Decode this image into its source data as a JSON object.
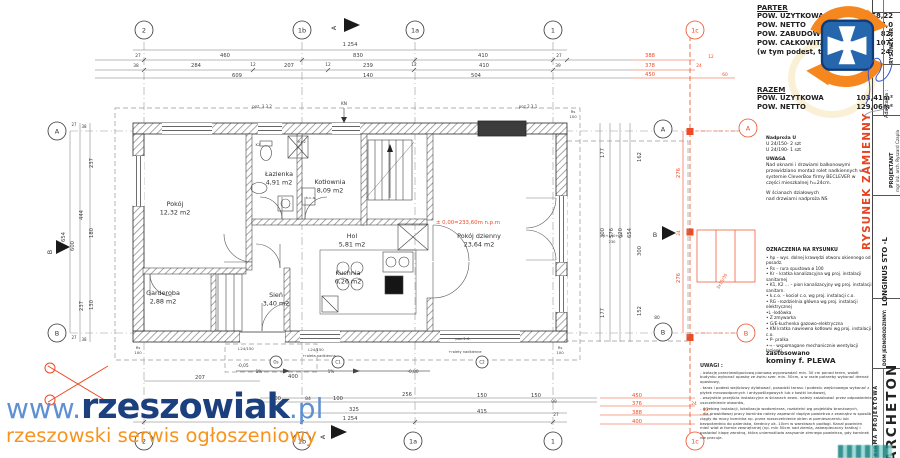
{
  "stats": {
    "parter_title": "PARTER",
    "parter_rows": [
      {
        "label": "POW. UZYTKOWA",
        "value": "58,22"
      },
      {
        "label": "POW. NETTO",
        "value": "67,0"
      },
      {
        "label": "POW. ZABUDOWY",
        "value": "82,"
      },
      {
        "label": "POW. CAŁKOWITA",
        "value": "107,"
      },
      {
        "label": "(w tym podest, taras",
        "value": "24,"
      }
    ],
    "razem_title": "RAZEM",
    "razem_rows": [
      {
        "label": "POW. UZYTKOWA",
        "value": "103,41m²"
      },
      {
        "label": "POW. NETTO",
        "value": "129,06m²"
      }
    ]
  },
  "notes": {
    "nadproza_title": "Nadproża U",
    "nadproza_l1": "U 24/150- 2 szt",
    "nadproza_l2": "U 24/190- 1 szt",
    "uwaga_title": "UWAGA",
    "uwaga_text": "Nad oknami i drzwiami balkonowymi przewidziano montaż rolet nadkiennych w systemie CleverBox firmy BECLEVER  w części mieszkalnej  h=24cm.",
    "sciany_text1": "W ścianach działowych",
    "sciany_text2": "nad drzwiami nadproża NS",
    "oznaczenia_title": "OZNACZENIA NA RYSUNKU",
    "oznaczenia_items": [
      "• hp – wys. dolnej krawędzi otworu  okiennego od posadz.",
      "• Rs – rura spustowa ø 100",
      "• Kr – kratka kanalizacyjna wg proj. instalacji sanitarnej",
      "• K1, K2 ... – pion kanalizacyjny wg proj. instalacji sanitarn.",
      "• k.c.o. – kocioł c.o.  wg proj. instalacji c.o.",
      "• RG –rozdzielnia główna wg proj. instalacji elektrycznej",
      "•L -lodówka",
      "• Z zmywarka",
      "• G/E-kuchenka gazowo-elektryczna",
      "• KN kratka nawiewna kotłowni wg proj. instalacji c.o.",
      "• P- pralka",
      "•⇢  - wspomagane mechanicznie wentylacji łazienki"
    ],
    "kominy_l1": "zastosowano",
    "kominy_l2": "kominy f. PLEWA",
    "uwagi_title": "UWAGI :",
    "uwagi_items": [
      "- izolację przeciwwilgociową pionową wyprowadzić min. 30 cm ponad teren, wokół budynku wykonać opaskę ze żwiru szer. min. 50cm, a w razie potrzeby wykonać drenaż opaskowy,",
      "- taras i podest wejściowy dylatować, posadzki tarasu i podestu wejściowego wykonać  z płytek mrozoodpornych i antypoślizgowych lub z kostki brukowej,",
      "- wszystkie przejścia instalacyjne w ścianach zewn. należy zaizolować przez odpowiednie uszczelnienie otworów,",
      "- przebieg instalacji, lokalizacja wodomierza, rozdzielni  wg projektów branżowych,",
      "- dla prawidłowej pracy kominka należy zapewnić dopływ powietrza z zewnątrz w sposób ciągły do mocy kominka np. przez rozszczelnienie okien w pomieszczeniu lub bezpośrednio do paleniska, średnicy ok. 10cm w warstwach podłogi. Kanał powinien mieć wlot w formie zewnętrznej (np. min 50cm nad ziemią, zabezpieczony kratką) i posiadać klapę zwrotną, która uniemożliwia zasysanie zimnego powietrza, gdy kominek nie pracuje."
    ]
  },
  "titleblock": {
    "rysunek_nr": "RYSUNEK NR",
    "adaptacja": "Adaptacja :",
    "rysunek_zamienny": "RYSUNEK ZAMIENNY",
    "projektant_label": "PROJEKTANT",
    "projektant_name": "mgr inż. arch. Ryszard Czapla",
    "project_name": "LONGINUS STO -L",
    "dom_label": "DOM JEDNORODZINNY:",
    "firma_label": "FIRMA PROJEKTOWA",
    "firma_name": "ARCHETON"
  },
  "watermark": {
    "www": "www.",
    "name": "rzeszowiak",
    "tld": ".pl",
    "tagline": "rzeszowski serwis ogłoszeniowy",
    "color_light": "#5f90d2",
    "color_dark": "#1c3f7e",
    "color_tag": "#f7941e"
  },
  "plan": {
    "level_mark": "± 0,00=233,60m n.p.m",
    "rooms": [
      {
        "name": "Pokój",
        "area": "12,32 m2",
        "x": 175,
        "y": 206
      },
      {
        "name": "Łazienka",
        "area": "4,91 m2",
        "x": 279,
        "y": 176
      },
      {
        "name": "Kotłownia",
        "area": "8,09 m2",
        "x": 330,
        "y": 184
      },
      {
        "name": "Hol",
        "area": "5,81 m2",
        "x": 352,
        "y": 238
      },
      {
        "name": "Kuchnia",
        "area": "6,26 m2",
        "x": 348,
        "y": 275
      },
      {
        "name": "Garderoba",
        "area": "2,88 m2",
        "x": 163,
        "y": 295
      },
      {
        "name": "Sień",
        "area": "3,40 m2",
        "x": 276,
        "y": 297
      },
      {
        "name": "Pokój dzienny",
        "area": "23,64 m2",
        "x": 479,
        "y": 238
      }
    ],
    "bubbles": [
      {
        "x": 144,
        "y": 30,
        "t": "2"
      },
      {
        "x": 302,
        "y": 30,
        "t": "1b"
      },
      {
        "x": 415,
        "y": 30,
        "t": "1a"
      },
      {
        "x": 553,
        "y": 30,
        "t": "1"
      },
      {
        "x": 695,
        "y": 30,
        "t": "1c",
        "c": "red"
      },
      {
        "x": 144,
        "y": 441,
        "t": "2"
      },
      {
        "x": 302,
        "y": 441,
        "t": "1b"
      },
      {
        "x": 413,
        "y": 441,
        "t": "1a"
      },
      {
        "x": 553,
        "y": 441,
        "t": "1"
      },
      {
        "x": 695,
        "y": 441,
        "t": "1c",
        "c": "red"
      },
      {
        "x": 57,
        "y": 131,
        "t": "A"
      },
      {
        "x": 57,
        "y": 333,
        "t": "B"
      },
      {
        "x": 663,
        "y": 129,
        "t": "A"
      },
      {
        "x": 663,
        "y": 332,
        "t": "B"
      },
      {
        "x": 748,
        "y": 128,
        "t": "A",
        "c": "red"
      },
      {
        "x": 746,
        "y": 333,
        "t": "B",
        "c": "red"
      },
      {
        "x": 276,
        "y": 362,
        "t": "Os",
        "r": 6,
        "s": 4
      },
      {
        "x": 338,
        "y": 362,
        "t": "C1",
        "r": 6,
        "s": 4
      },
      {
        "x": 482,
        "y": 362,
        "t": "C2",
        "r": 6,
        "s": 4
      }
    ],
    "labels": [
      {
        "x": 350,
        "y": 46,
        "t": "1 254"
      },
      {
        "x": 138,
        "y": 57,
        "t": "27",
        "s": 4.3
      },
      {
        "x": 225,
        "y": 57,
        "t": "460"
      },
      {
        "x": 358,
        "y": 57,
        "t": "830"
      },
      {
        "x": 483,
        "y": 57,
        "t": "410"
      },
      {
        "x": 559,
        "y": 57,
        "t": "27",
        "s": 4.3
      },
      {
        "x": 136,
        "y": 67,
        "t": "38",
        "s": 4.3
      },
      {
        "x": 196,
        "y": 67,
        "t": "284"
      },
      {
        "x": 253,
        "y": 66,
        "t": "12",
        "s": 4.3
      },
      {
        "x": 289,
        "y": 67,
        "t": "207"
      },
      {
        "x": 328,
        "y": 66,
        "t": "12",
        "s": 4.3
      },
      {
        "x": 368,
        "y": 67,
        "t": "239"
      },
      {
        "x": 414,
        "y": 66,
        "t": "12",
        "s": 4.3
      },
      {
        "x": 484,
        "y": 67,
        "t": "410"
      },
      {
        "x": 558,
        "y": 67,
        "t": "39",
        "s": 4.3
      },
      {
        "x": 237,
        "y": 77,
        "t": "609"
      },
      {
        "x": 368,
        "y": 77,
        "t": "140"
      },
      {
        "x": 476,
        "y": 77,
        "t": "504"
      },
      {
        "x": 650,
        "y": 57,
        "t": "388",
        "c": "red"
      },
      {
        "x": 650,
        "y": 67,
        "t": "378",
        "c": "red"
      },
      {
        "x": 650,
        "y": 76,
        "t": "450",
        "c": "red"
      },
      {
        "x": 711,
        "y": 58,
        "t": "12",
        "c": "red",
        "s": 4.3
      },
      {
        "x": 699,
        "y": 67,
        "t": "24",
        "c": "red",
        "s": 4.3
      },
      {
        "x": 725,
        "y": 76,
        "t": "60",
        "c": "red",
        "s": 4.3
      },
      {
        "x": 74,
        "y": 126,
        "t": "27",
        "s": 4
      },
      {
        "x": 84,
        "y": 128,
        "t": "38",
        "s": 4
      },
      {
        "x": 93,
        "y": 163,
        "t": "237",
        "r": -90
      },
      {
        "x": 83,
        "y": 215,
        "t": "444",
        "r": -90
      },
      {
        "x": 93,
        "y": 233,
        "t": "180",
        "r": -90
      },
      {
        "x": 65,
        "y": 237,
        "t": "654",
        "r": -90
      },
      {
        "x": 74,
        "y": 246,
        "t": "600",
        "r": -90
      },
      {
        "x": 93,
        "y": 305,
        "t": "130",
        "r": -90
      },
      {
        "x": 83,
        "y": 306,
        "t": "237",
        "r": -90
      },
      {
        "x": 74,
        "y": 339,
        "t": "27",
        "s": 4
      },
      {
        "x": 84,
        "y": 341,
        "t": "38",
        "s": 4
      },
      {
        "x": 604,
        "y": 153,
        "t": "177",
        "r": -90
      },
      {
        "x": 641,
        "y": 157,
        "t": "162",
        "r": -90
      },
      {
        "x": 604,
        "y": 233,
        "t": "300",
        "r": -90
      },
      {
        "x": 613,
        "y": 233,
        "t": "576",
        "r": -90
      },
      {
        "x": 622,
        "y": 233,
        "t": "620",
        "r": -90
      },
      {
        "x": 631,
        "y": 233,
        "t": "654",
        "r": -90
      },
      {
        "x": 641,
        "y": 251,
        "t": "300",
        "r": -90
      },
      {
        "x": 641,
        "y": 311,
        "t": "152",
        "r": -90
      },
      {
        "x": 604,
        "y": 313,
        "t": "177",
        "r": -90
      },
      {
        "x": 657,
        "y": 319,
        "t": "80",
        "s": 4.3
      },
      {
        "x": 680,
        "y": 173,
        "t": "276",
        "c": "red",
        "r": -90
      },
      {
        "x": 680,
        "y": 233,
        "t": "24",
        "c": "red",
        "s": 4.3,
        "r": -90
      },
      {
        "x": 680,
        "y": 278,
        "t": "276",
        "c": "red",
        "r": -90
      },
      {
        "x": 723,
        "y": 282,
        "t": "3x15/30",
        "c": "red",
        "s": 4.2,
        "r": -60
      },
      {
        "x": 200,
        "y": 379,
        "t": "207"
      },
      {
        "x": 243,
        "y": 367,
        "t": "-0,05",
        "s": 4.3
      },
      {
        "x": 259,
        "y": 373,
        "t": "1%",
        "s": 4.3
      },
      {
        "x": 293,
        "y": 378,
        "t": "400"
      },
      {
        "x": 331,
        "y": 373,
        "t": "1%",
        "s": 4.3
      },
      {
        "x": 413,
        "y": 373,
        "t": "-0,80",
        "s": 4.3
      },
      {
        "x": 276,
        "y": 400,
        "t": "100"
      },
      {
        "x": 308,
        "y": 400,
        "t": "84",
        "s": 4.5
      },
      {
        "x": 338,
        "y": 400,
        "t": "100"
      },
      {
        "x": 407,
        "y": 396,
        "t": "256"
      },
      {
        "x": 482,
        "y": 397,
        "t": "150"
      },
      {
        "x": 536,
        "y": 397,
        "t": "150"
      },
      {
        "x": 554,
        "y": 403,
        "t": "99",
        "s": 4.3
      },
      {
        "x": 354,
        "y": 411,
        "t": "325"
      },
      {
        "x": 350,
        "y": 420,
        "t": "1 254"
      },
      {
        "x": 482,
        "y": 413,
        "t": "415"
      },
      {
        "x": 556,
        "y": 416,
        "t": "27",
        "s": 4.3
      },
      {
        "x": 637,
        "y": 397,
        "t": "450",
        "c": "red"
      },
      {
        "x": 637,
        "y": 405,
        "t": "376",
        "c": "red"
      },
      {
        "x": 637,
        "y": 414,
        "t": "388",
        "c": "red"
      },
      {
        "x": 637,
        "y": 423,
        "t": "400",
        "c": "red"
      },
      {
        "x": 694,
        "y": 405,
        "t": "24",
        "c": "red",
        "s": 4.3
      },
      {
        "x": 706,
        "y": 411,
        "t": "12",
        "c": "red",
        "s": 4.3
      },
      {
        "x": 262,
        "y": 108,
        "t": "poz. 3.3.2",
        "s": 4
      },
      {
        "x": 344,
        "y": 105,
        "t": "KN",
        "s": 4.3
      },
      {
        "x": 528,
        "y": 108,
        "t": "poz 2.3.1",
        "s": 4
      },
      {
        "x": 573,
        "y": 113,
        "t": "Rs",
        "s": 3.8
      },
      {
        "x": 573,
        "y": 118,
        "t": "100",
        "s": 3.8
      },
      {
        "x": 138,
        "y": 349,
        "t": "Rs",
        "s": 3.8
      },
      {
        "x": 138,
        "y": 354,
        "t": "100",
        "s": 3.8
      },
      {
        "x": 560,
        "y": 349,
        "t": "Rs",
        "s": 3.8
      },
      {
        "x": 560,
        "y": 354,
        "t": "100",
        "s": 3.8
      },
      {
        "x": 246,
        "y": 350,
        "t": "L24/150",
        "s": 3.8
      },
      {
        "x": 316,
        "y": 351,
        "t": "L24/150",
        "s": 3.8
      },
      {
        "x": 319,
        "y": 357,
        "t": "+roleta nadkienna",
        "s": 3.6
      },
      {
        "x": 463,
        "y": 340,
        "t": "poz.2.6.",
        "s": 3.8
      },
      {
        "x": 465,
        "y": 353,
        "t": "+rolety nadkienne",
        "s": 3.6
      },
      {
        "x": 311,
        "y": 199,
        "t": "k.c.o.",
        "s": 3.8
      },
      {
        "x": 258,
        "y": 146,
        "t": "KZ",
        "s": 3.8
      },
      {
        "x": 302,
        "y": 143,
        "t": "Kr-2",
        "s": 3.8
      },
      {
        "x": 612,
        "y": 237,
        "t": "75+150+75",
        "s": 3.6
      },
      {
        "x": 612,
        "y": 243,
        "t": "230",
        "s": 3.6
      },
      {
        "x": 468,
        "y": 224,
        "t": "± 0,00=233,60m n.p.m",
        "c": "red",
        "s": 5.4
      },
      {
        "x": 336,
        "y": 28,
        "t": "A",
        "s": 6.5,
        "r": -90
      },
      {
        "x": 325,
        "y": 437,
        "t": "A",
        "s": 6.5,
        "r": -90
      },
      {
        "x": 52,
        "y": 252,
        "t": "B",
        "s": 6.5,
        "r": -90
      },
      {
        "x": 655,
        "y": 237,
        "t": "B",
        "s": 6.5
      }
    ]
  }
}
